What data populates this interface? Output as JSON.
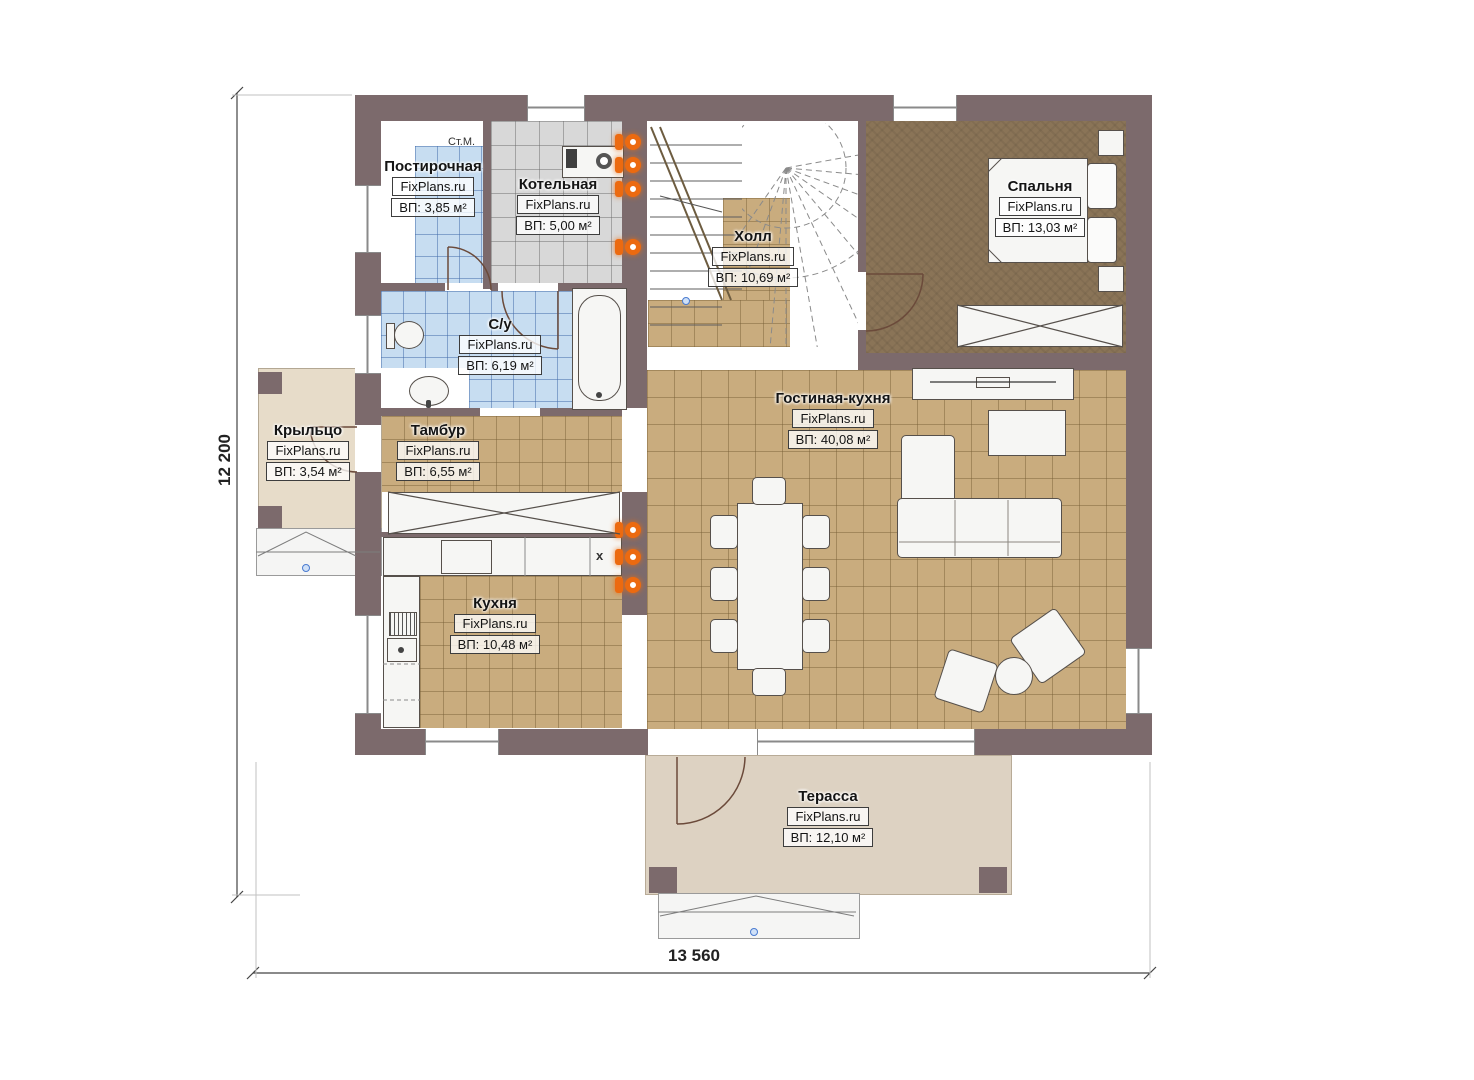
{
  "plan": {
    "type": "floor-plan",
    "brand_watermark": "FixPlans.ru"
  },
  "dimensions": {
    "height_label": "12 200",
    "width_label": "13 560"
  },
  "annotations": {
    "washing_machine": "Ст.М.",
    "sink_mark": "x"
  },
  "rooms": [
    {
      "name": "Постирочная",
      "brand": "FixPlans.ru",
      "area": "ВП: 3,85 м²"
    },
    {
      "name": "Котельная",
      "brand": "FixPlans.ru",
      "area": "ВП: 5,00 м²"
    },
    {
      "name": "Холл",
      "brand": "FixPlans.ru",
      "area": "ВП: 10,69 м²"
    },
    {
      "name": "Спальня",
      "brand": "FixPlans.ru",
      "area": "ВП: 13,03 м²"
    },
    {
      "name": "С/у",
      "brand": "FixPlans.ru",
      "area": "ВП: 6,19 м²"
    },
    {
      "name": "Крыльцо",
      "brand": "FixPlans.ru",
      "area": "ВП: 3,54 м²"
    },
    {
      "name": "Тамбур",
      "brand": "FixPlans.ru",
      "area": "ВП: 6,55 м²"
    },
    {
      "name": "Гостиная-кухня",
      "brand": "FixPlans.ru",
      "area": "ВП: 40,08 м²"
    },
    {
      "name": "Кухня",
      "brand": "FixPlans.ru",
      "area": "ВП: 10,48 м²"
    },
    {
      "name": "Терасса",
      "brand": "FixPlans.ru",
      "area": "ВП: 12,10 м²"
    }
  ],
  "colors": {
    "wall": "#7c6a6c",
    "floor_tan": "#c9ac7e",
    "floor_blue": "#c7ddf1",
    "floor_gray": "#d8d8d8",
    "floor_bedroom": "#8a7457",
    "terrace": "#ddd2c2",
    "porch": "#e7dcc9",
    "radiator_orange": "#ec6a10",
    "marker_blue": "#4a7bd0"
  }
}
